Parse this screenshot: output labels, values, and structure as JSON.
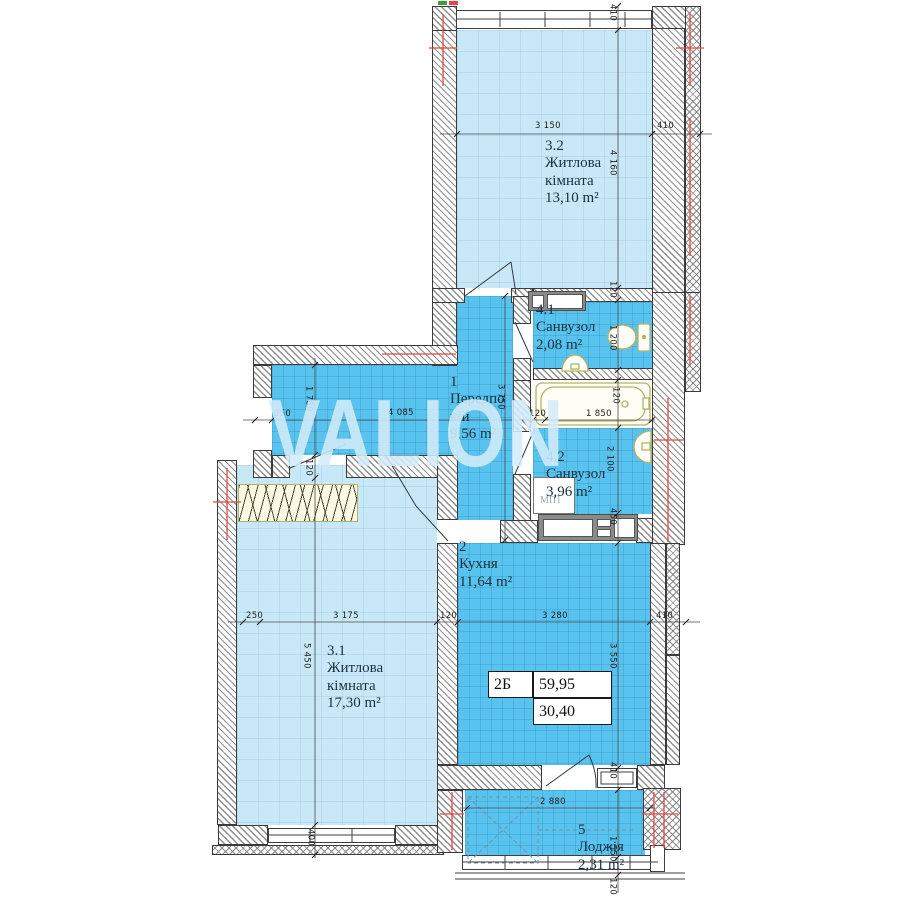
{
  "watermark": "VALION",
  "info_table": {
    "type_label": "2Б",
    "total_area": "59,95",
    "living_area": "30,40"
  },
  "rooms": {
    "hallway": {
      "num": "1",
      "line1": "Передпо",
      "line2": "кій",
      "area": "9,56 m²"
    },
    "kitchen": {
      "num": "2",
      "line1": "Кухня",
      "area": "11,64 m²"
    },
    "living1": {
      "num": "3.1",
      "line1": "Житлова",
      "line2": "кімната",
      "area": "17,30 m²"
    },
    "living2": {
      "num": "3.2",
      "line1": "Житлова",
      "line2": "кімната",
      "area": "13,10 m²"
    },
    "bath1": {
      "num": "4.1",
      "line1": "Санвузол",
      "area": "2,08 m²"
    },
    "bath2": {
      "num": "4.2",
      "line1": "Санвузол",
      "area": "3,96 m²"
    },
    "loggia": {
      "num": "5",
      "line1": "Лоджія",
      "area": "2,31 m²"
    }
  },
  "annotations": {
    "window_mark": "МП1"
  },
  "dims": {
    "top_410": "410",
    "w3150": "3 150",
    "right_410": "410",
    "h4160": "4 160",
    "t120a": "120",
    "h1200": "1 200",
    "t120b": "120",
    "t120c": "120",
    "w1850": "1 850",
    "h2100": "2 100",
    "h450": "450",
    "hall250": "250",
    "w4085": "4 085",
    "h1780": "1 780",
    "h3750": "3 750",
    "t120d": "120",
    "r250": "250",
    "w3175": "3 175",
    "t120e": "120",
    "w3280": "3 280",
    "k410": "410",
    "h3550": "3 550",
    "h5450": "5 450",
    "h400": "400",
    "l410": "410",
    "w2880": "2 880",
    "h1550": "1 550",
    "t120f": "120"
  },
  "colors": {
    "room_light": "#c9e8f7",
    "room_tile": "#58c3ef",
    "wall_line": "#3b3b3b",
    "axis_red": "#e8463e",
    "fixture": "#b5b362",
    "watermark": "#d3ecfa"
  }
}
